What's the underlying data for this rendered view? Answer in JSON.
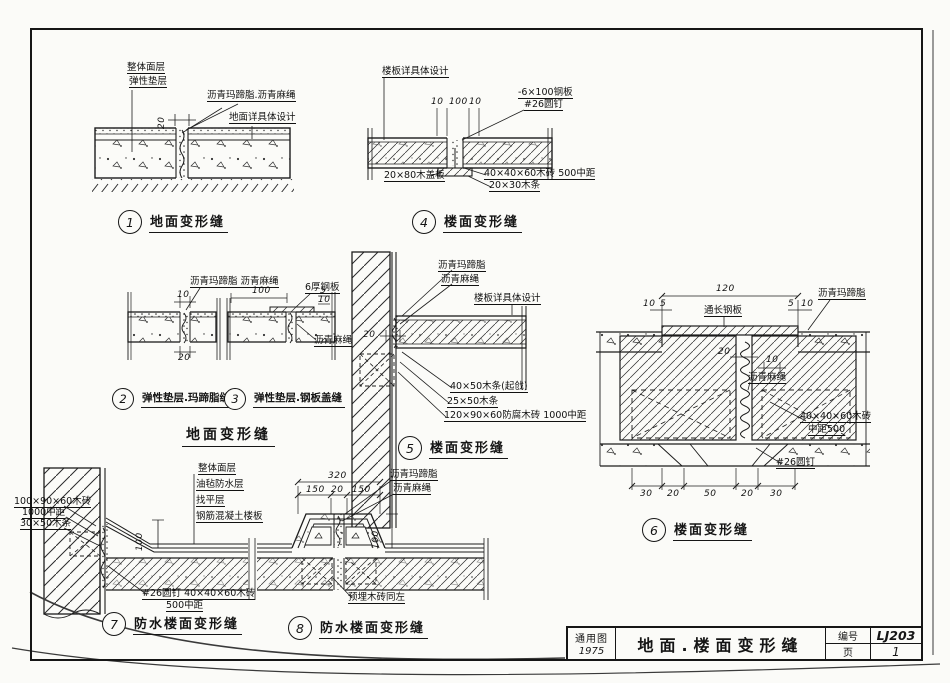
{
  "colors": {
    "ink": "#161616",
    "paper": "#fbfbf8"
  },
  "title_block": {
    "type_label": "通用图",
    "year": "1975",
    "sheet_title": "地面.楼面变形缝",
    "number_label": "编号",
    "sheet_number": "LJ203",
    "page_label": "页",
    "page_number": "1"
  },
  "d1": {
    "num": "1",
    "caption": "地面变形缝",
    "surface": "整体面层",
    "cushion": "弹性垫层",
    "mastic_rope": "沥青玛蹄脂.沥青麻绳",
    "design": "地面详具体设计",
    "dim_20": "20"
  },
  "d23": {
    "num2": "2",
    "num3": "3",
    "caption2": "弹性垫层.玛蹄脂缝",
    "caption3": "弹性垫层.钢板盖缝",
    "group_caption": "地面变形缝",
    "mastic_rope": "沥青玛蹄脂 沥青麻绳",
    "steel_plate": "6厚钢板",
    "rope": "沥青麻绳",
    "dim_10": "10",
    "dim_20": "20",
    "dim_100": "100",
    "dim_5": "5"
  },
  "d4": {
    "num": "4",
    "caption": "楼面变形缝",
    "slab_design": "楼板详具体设计",
    "dim_10a": "10",
    "dim_100": "100",
    "dim_10b": "10",
    "steel": "-6×100钢板",
    "nail": "#26圆钉",
    "cover": "20×80木盖板",
    "brick": "40×40×60木砖 500中距",
    "strip": "20×30木条"
  },
  "d5": {
    "num": "5",
    "caption": "楼面变形缝",
    "mastic": "沥青玛蹄脂",
    "rope": "沥青麻绳",
    "slab_design": "楼板详具体设计",
    "dim_20": "20",
    "strip1": "40×50木条(起戗)",
    "strip2": "25×50木条",
    "brick": "120×90×60防腐木砖 1000中距"
  },
  "d6": {
    "num": "6",
    "caption": "楼面变形缝",
    "dim_120": "120",
    "dim_10": "10",
    "dim_5": "5",
    "dim_20": "20",
    "plate": "通长钢板",
    "mastic": "沥青玛蹄脂",
    "rope": "沥青麻绳",
    "brick": "40×40×60木砖",
    "spacing": "中距500",
    "nail": "#26圆钉",
    "dims_bottom": [
      "30",
      "20",
      "50",
      "20",
      "30"
    ]
  },
  "d7": {
    "num": "7",
    "caption": "防水楼面变形缝",
    "layer1": "整体面层",
    "layer2": "油毡防水层",
    "layer3": "找平层",
    "layer4": "钢筋混凝土楼板",
    "brick_left": "100×90×60木砖",
    "spacing_left": "1000中距",
    "strip_left": "30×50木条",
    "dim_100": "100",
    "nail_brick": "#26圆钉 40×40×60木砖",
    "spacing": "500中距"
  },
  "d8": {
    "num": "8",
    "caption": "防水楼面变形缝",
    "dim_320": "320",
    "dim_150a": "150",
    "dim_20": "20",
    "dim_150b": "150",
    "dim_100": "100",
    "mastic": "沥青玛蹄脂",
    "rope": "沥青麻绳",
    "note": "预埋木砖同左"
  }
}
